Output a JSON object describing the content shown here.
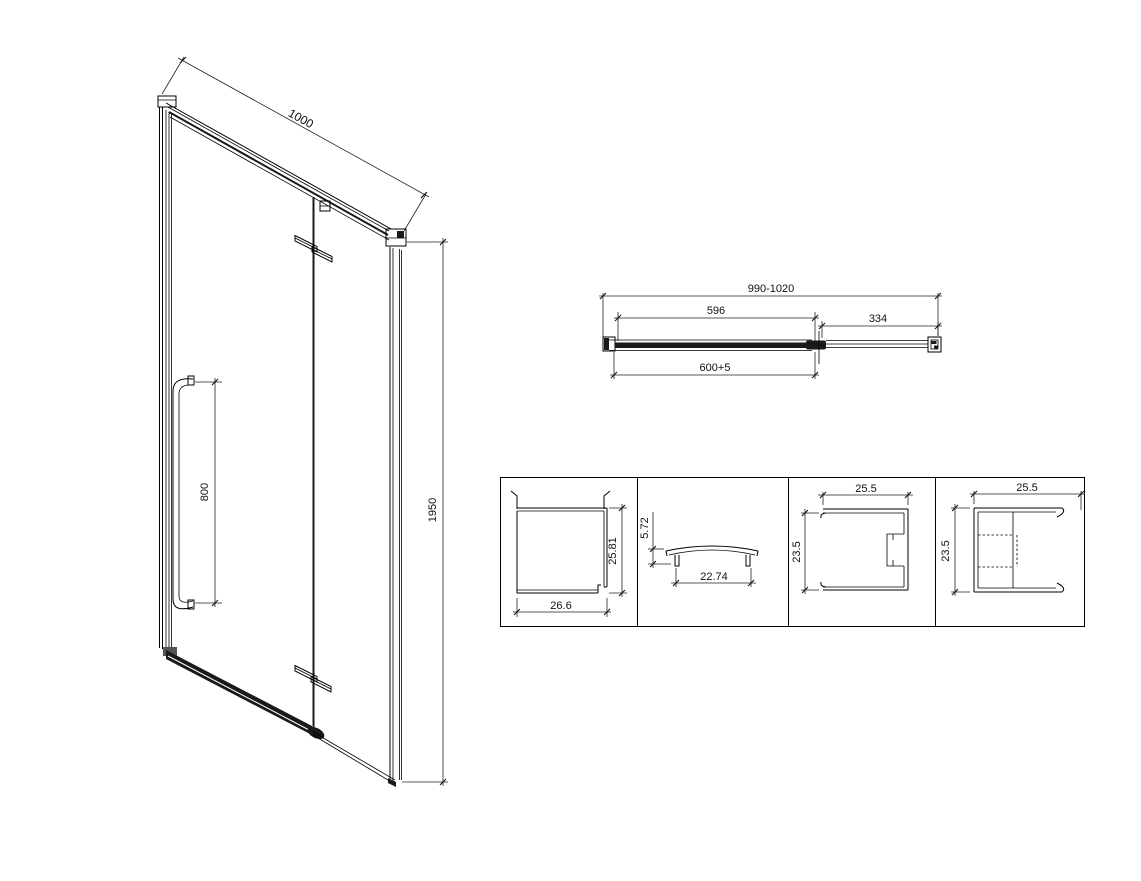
{
  "drawing": {
    "background": "#ffffff",
    "line_color": "#000000",
    "iso_view": {
      "width_dim": "1000",
      "handle_dim": "800",
      "height_dim": "1950"
    },
    "plan_view": {
      "overall_dim": "990-1020",
      "door_glass_dim": "596",
      "fixed_panel_dim": "334",
      "entry_dim": "600+5"
    },
    "profile_details": [
      {
        "name": "wall-channel-profile",
        "height_dim": "25.81",
        "width_dim": "26.6"
      },
      {
        "name": "cover-cap-profile",
        "height_dim": "5.72",
        "width_dim": "22.74"
      },
      {
        "name": "slotted-channel-profile",
        "width_dim": "25.5",
        "height_dim": "23.5"
      },
      {
        "name": "glazing-channel-profile",
        "width_dim": "25.5",
        "height_dim": "23.5"
      }
    ]
  }
}
